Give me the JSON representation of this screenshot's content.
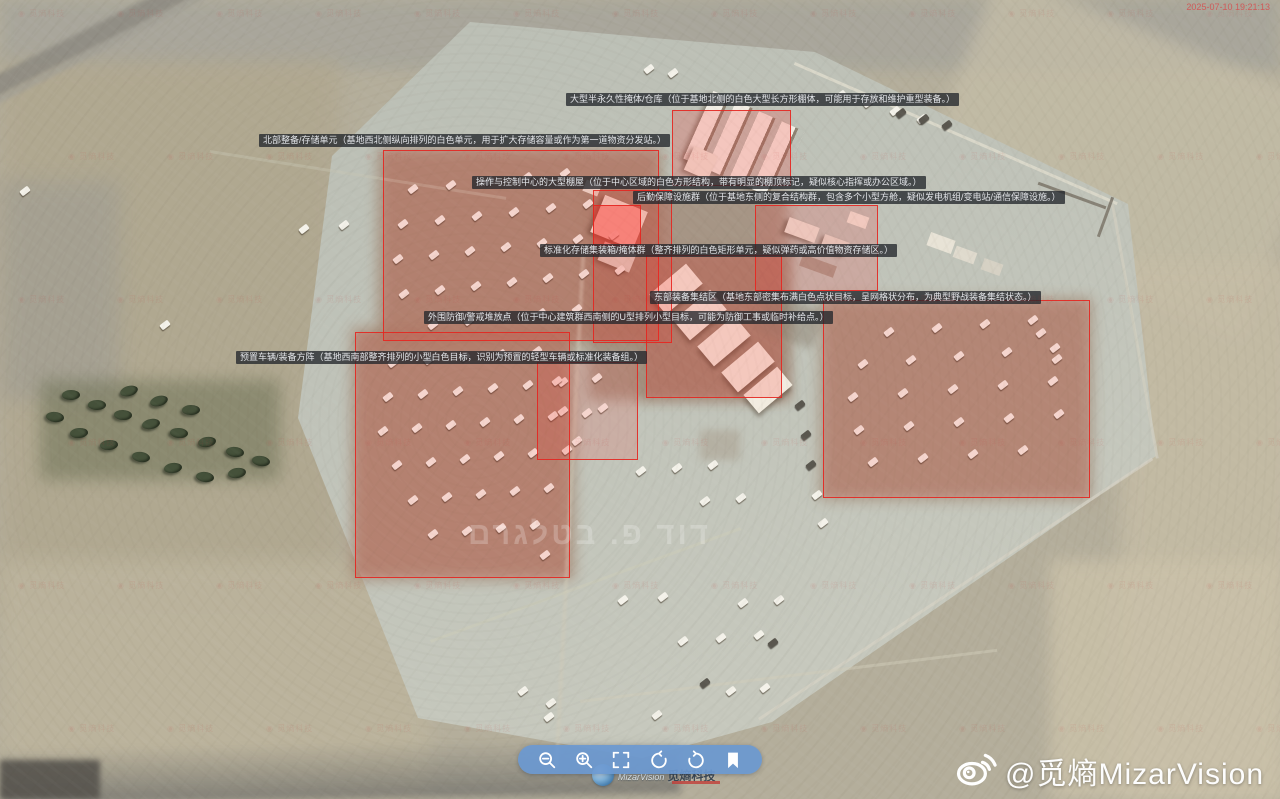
{
  "meta": {
    "timestamp": "2025-07-10 19:21:13"
  },
  "watermarks": {
    "tile_text": "觅熵科技",
    "center_text": "דוד פ. בטלגרם",
    "weibo_handle": "@觅熵MizarVision",
    "logo_en": "MizarVision",
    "logo_cn": "觅熵科技"
  },
  "toolbar": {
    "buttons": [
      {
        "icon": "zoom-out-icon"
      },
      {
        "icon": "zoom-in-icon"
      },
      {
        "icon": "fullscreen-icon"
      },
      {
        "icon": "rotate-ccw-icon"
      },
      {
        "icon": "rotate-cw-icon"
      },
      {
        "icon": "bookmark-icon"
      }
    ]
  },
  "annotations": {
    "labels": [
      {
        "name": "label-north-shelter",
        "x": 566,
        "y": 93,
        "text": "大型半永久性掩体/仓库（位于基地北侧的白色大型长方形棚体，可能用于存放和维护重型装备。）"
      },
      {
        "name": "label-north-storage",
        "x": 259,
        "y": 134,
        "text": "北部整备/存储单元（基地西北侧纵向排列的白色单元，用于扩大存储容量或作为第一道物资分发站。）"
      },
      {
        "name": "label-control-shed",
        "x": 472,
        "y": 176,
        "text": "操作与控制中心的大型棚屋（位于中心区域的白色方形结构，带有明显的棚顶标记，疑似核心指挥或办公区域。）"
      },
      {
        "name": "label-logistics",
        "x": 633,
        "y": 191,
        "text": "后勤保障设施群（位于基地东侧的复合结构群，包含多个小型方舱，疑似发电机组/变电站/通信保障设施。）"
      },
      {
        "name": "label-containers",
        "x": 540,
        "y": 244,
        "text": "标准化存储集装箱/掩体群（整齐排列的白色矩形单元，疑似弹药或高价值物资存储区。）"
      },
      {
        "name": "label-east-assembly",
        "x": 650,
        "y": 291,
        "text": "东部装备集结区（基地东部密集布满白色点状目标，呈网格状分布，为典型野战装备集结状态。）"
      },
      {
        "name": "label-perimeter",
        "x": 424,
        "y": 311,
        "text": "外围防御/警戒堆放点（位于中心建筑群西南侧的U型排列小型目标，可能为防御工事或临时补给点。）"
      },
      {
        "name": "label-preset-array",
        "x": 236,
        "y": 351,
        "text": "预置车辆/装备方阵（基地西南部整齐排列的小型白色目标，识别为预置的轻型车辆或标准化装备组。）"
      }
    ],
    "regions": [
      {
        "name": "region-nw-vehicle-rows",
        "x": 383,
        "y": 150,
        "w": 276,
        "h": 191,
        "opacity": 0.14
      },
      {
        "name": "region-north-warehouse",
        "x": 672,
        "y": 110,
        "w": 119,
        "h": 76,
        "opacity": 0.2
      },
      {
        "name": "region-control-shed",
        "x": 593,
        "y": 190,
        "w": 79,
        "h": 153,
        "opacity": 0.12
      },
      {
        "name": "region-control-highlight",
        "x": 593,
        "y": 205,
        "w": 48,
        "h": 41,
        "opacity": 0.38
      },
      {
        "name": "region-logistics-cluster",
        "x": 755,
        "y": 205,
        "w": 123,
        "h": 86,
        "opacity": 0.16
      },
      {
        "name": "region-container-storage",
        "x": 646,
        "y": 255,
        "w": 136,
        "h": 143,
        "opacity": 0.18
      },
      {
        "name": "region-east-assembly",
        "x": 823,
        "y": 300,
        "w": 267,
        "h": 198,
        "opacity": 0.14
      },
      {
        "name": "region-sw-vehicle-array",
        "x": 355,
        "y": 332,
        "w": 215,
        "h": 246,
        "opacity": 0.14
      },
      {
        "name": "region-perimeter-defense",
        "x": 537,
        "y": 362,
        "w": 101,
        "h": 98,
        "opacity": 0.14
      }
    ]
  }
}
